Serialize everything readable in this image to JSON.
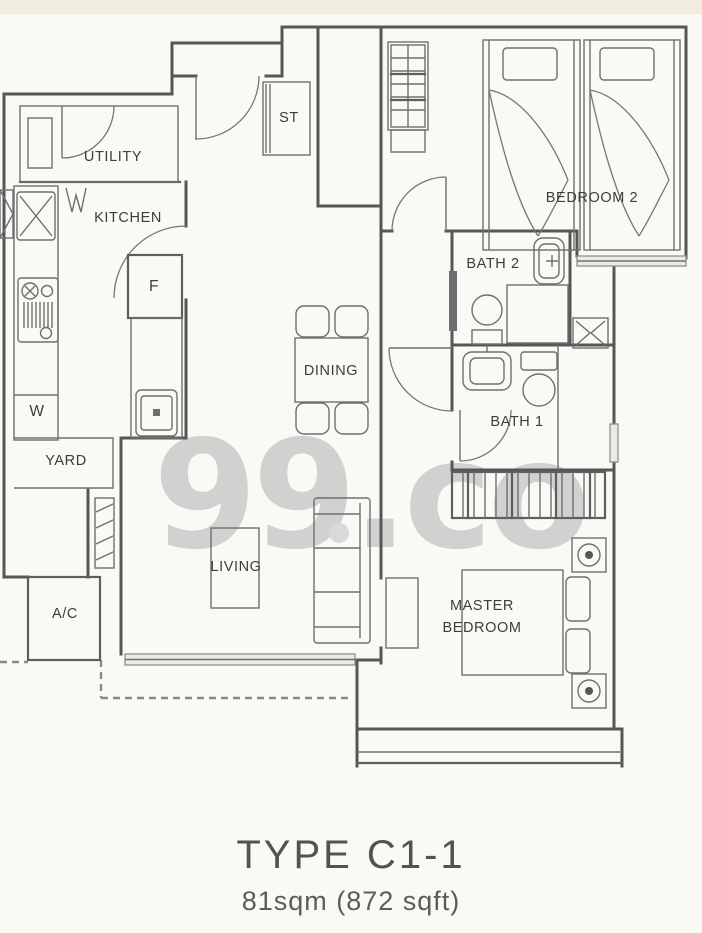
{
  "watermark_text": "99.co",
  "plan": {
    "labels": {
      "utility": "UTILITY",
      "kitchen": "KITCHEN",
      "store": "ST",
      "bedroom2": "BEDROOM 2",
      "bath2": "BATH 2",
      "bath1": "BATH 1",
      "dining": "DINING",
      "fridge": "F",
      "washer": "W",
      "yard": "YARD",
      "living": "LIVING",
      "ac": "A/C",
      "master_line1": "MASTER",
      "master_line2": "BEDROOM"
    }
  },
  "caption": {
    "type_label": "TYPE C1-1",
    "area_label": "81sqm (872 sqft)"
  },
  "colors": {
    "background": "#fbf9f5",
    "top_band": "#f2ecdd",
    "wall": "#565656",
    "thin_line": "#6f6f6f",
    "watermark": "#c8c8c8",
    "label_text": "#3d3d3d",
    "caption_text": "#525252"
  }
}
